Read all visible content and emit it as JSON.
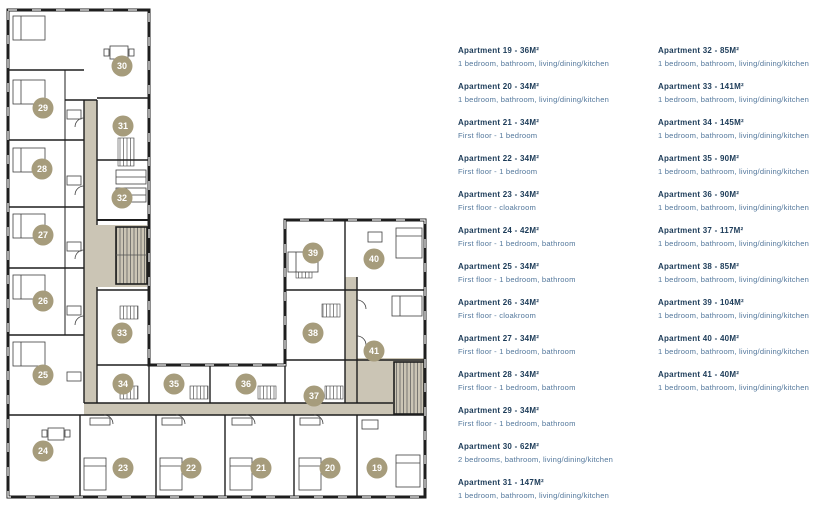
{
  "plan": {
    "colors": {
      "marker_fill": "#a69c7c",
      "marker_text": "#ffffff",
      "corridor": "#cbc5b5",
      "wall": "#1e1e1e",
      "furniture_line": "#3f3f3f"
    },
    "markers": [
      {
        "label": "19",
        "x": 377,
        "y": 468
      },
      {
        "label": "20",
        "x": 330,
        "y": 468
      },
      {
        "label": "21",
        "x": 261,
        "y": 468
      },
      {
        "label": "22",
        "x": 191,
        "y": 468
      },
      {
        "label": "23",
        "x": 123,
        "y": 468
      },
      {
        "label": "24",
        "x": 43,
        "y": 451
      },
      {
        "label": "25",
        "x": 43,
        "y": 375
      },
      {
        "label": "26",
        "x": 43,
        "y": 301
      },
      {
        "label": "27",
        "x": 43,
        "y": 235
      },
      {
        "label": "28",
        "x": 42,
        "y": 169
      },
      {
        "label": "29",
        "x": 43,
        "y": 108
      },
      {
        "label": "30",
        "x": 122,
        "y": 66
      },
      {
        "label": "31",
        "x": 123,
        "y": 126
      },
      {
        "label": "32",
        "x": 122,
        "y": 198
      },
      {
        "label": "33",
        "x": 122,
        "y": 333
      },
      {
        "label": "34",
        "x": 123,
        "y": 384
      },
      {
        "label": "35",
        "x": 174,
        "y": 384
      },
      {
        "label": "36",
        "x": 246,
        "y": 384
      },
      {
        "label": "37",
        "x": 314,
        "y": 396
      },
      {
        "label": "38",
        "x": 313,
        "y": 333
      },
      {
        "label": "39",
        "x": 313,
        "y": 253
      },
      {
        "label": "40",
        "x": 374,
        "y": 259
      },
      {
        "label": "41",
        "x": 374,
        "y": 351
      }
    ]
  },
  "listings": {
    "column1": [
      {
        "title": "Apartment 19 - 36M²",
        "desc": "1 bedroom, bathroom, living/dining/kitchen"
      },
      {
        "title": "Apartment 20 - 34M²",
        "desc": "1 bedroom, bathroom, living/dining/kitchen"
      },
      {
        "title": "Apartment 21 - 34M²",
        "desc": "First floor - 1 bedroom"
      },
      {
        "title": "Apartment 22 - 34M²",
        "desc": "First floor - 1 bedroom"
      },
      {
        "title": "Apartment 23 - 34M²",
        "desc": "First floor - cloakroom"
      },
      {
        "title": "Apartment 24 - 42M²",
        "desc": "First floor - 1 bedroom, bathroom"
      },
      {
        "title": "Apartment 25 - 34M²",
        "desc": "First floor - 1 bedroom, bathroom"
      },
      {
        "title": "Apartment 26 - 34M²",
        "desc": "First floor - cloakroom"
      },
      {
        "title": "Apartment 27 - 34M²",
        "desc": "First floor - 1 bedroom, bathroom"
      },
      {
        "title": "Apartment 28 - 34M²",
        "desc": "First floor - 1 bedroom, bathroom"
      },
      {
        "title": "Apartment 29 - 34M²",
        "desc": "First floor - 1 bedroom, bathroom"
      },
      {
        "title": "Apartment 30 - 62M²",
        "desc": "2 bedrooms, bathroom, living/dining/kitchen"
      },
      {
        "title": "Apartment 31 - 147M²",
        "desc": "1 bedroom, bathroom, living/dining/kitchen"
      }
    ],
    "column2": [
      {
        "title": "Apartment 32 - 85M²",
        "desc": "1 bedroom, bathroom, living/dining/kitchen"
      },
      {
        "title": "Apartment 33 - 141M²",
        "desc": "1 bedroom, bathroom, living/dining/kitchen"
      },
      {
        "title": "Apartment 34 - 145M²",
        "desc": "1 bedroom, bathroom, living/dining/kitchen"
      },
      {
        "title": "Apartment 35 - 90M²",
        "desc": "1 bedroom, bathroom, living/dining/kitchen"
      },
      {
        "title": "Apartment 36 - 90M²",
        "desc": "1 bedroom, bathroom, living/dining/kitchen"
      },
      {
        "title": "Apartment 37 - 117M²",
        "desc": "1 bedroom, bathroom, living/dining/kitchen"
      },
      {
        "title": "Apartment 38 - 85M²",
        "desc": "1 bedroom, bathroom, living/dining/kitchen"
      },
      {
        "title": "Apartment 39 - 104M²",
        "desc": "1 bedroom, bathroom, living/dining/kitchen"
      },
      {
        "title": "Apartment 40 - 40M²",
        "desc": "1 bedroom, bathroom, living/dining/kitchen"
      },
      {
        "title": "Apartment 41 - 40M²",
        "desc": "1 bedroom, bathroom, living/dining/kitchen"
      }
    ]
  }
}
